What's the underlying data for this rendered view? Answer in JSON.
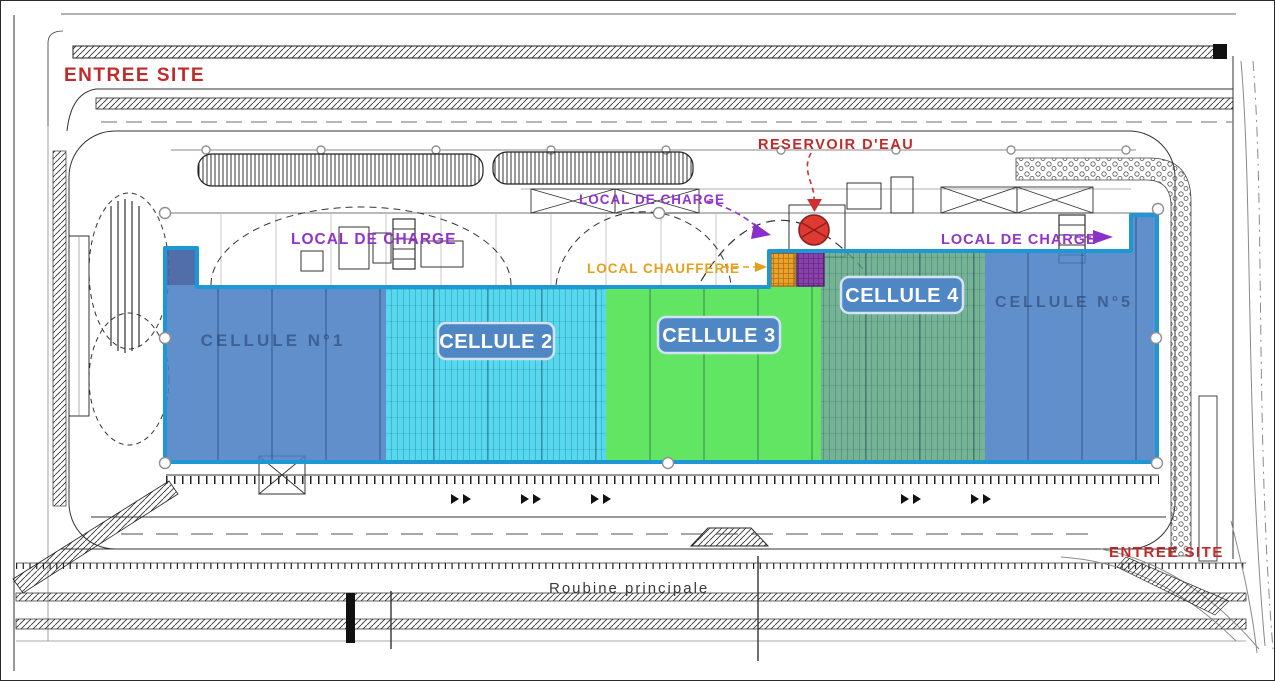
{
  "plan": {
    "title": "Site plan with warehouse cells overlay",
    "annotations": {
      "entree_site_top": "ENTREE SITE",
      "entree_site_bottom": "ENTREE SITE",
      "reservoir_eau": "RESERVOIR D'EAU",
      "local_de_charge_left": "LOCAL DE CHARGE",
      "local_de_charge_center": "LOCAL DE CHARGE",
      "local_de_charge_right": "LOCAL DE CHARGE",
      "local_chaufferie": "LOCAL CHAUFFERIE",
      "roubine_principale": "Roubine principale"
    },
    "colors": {
      "annotation_red": "#c22a2a",
      "annotation_purple": "#9333c9",
      "annotation_orange": "#e6a01e",
      "overlay_border_blue": "#1e97d5",
      "badge_blue": "#4f86c4",
      "reservoir_red": "#dd3a32",
      "charge_block_orange": "#eda126",
      "charge_block_purple": "#8a41ad"
    },
    "cells": [
      {
        "name": "cellule-1",
        "badge": "",
        "watermark": "CELLULE N°1",
        "color": "#4a80c4"
      },
      {
        "name": "cellule-2",
        "badge": "CELLULE 2",
        "watermark": "",
        "color": "#38d2ec"
      },
      {
        "name": "cellule-3",
        "badge": "CELLULE 3",
        "watermark": "",
        "color": "#47e148"
      },
      {
        "name": "cellule-4",
        "badge": "CELLULE 4",
        "watermark": "",
        "color": "#56a37d"
      },
      {
        "name": "cellule-5",
        "badge": "",
        "watermark": "CELLULE N°5",
        "color": "#4a80c4"
      }
    ]
  }
}
